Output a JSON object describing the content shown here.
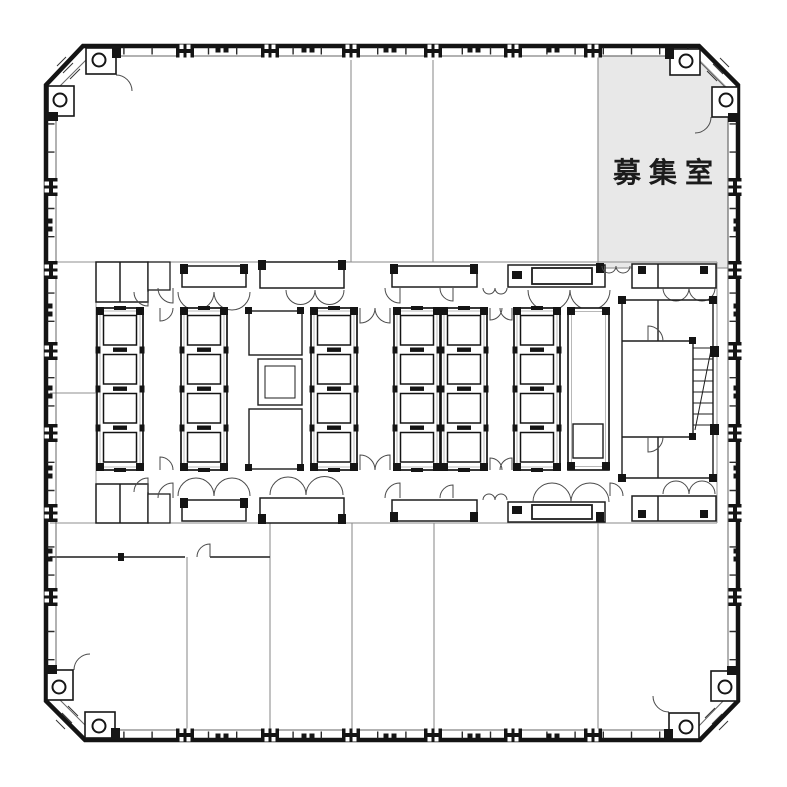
{
  "available_room": {
    "label": "募集室",
    "fill": "#e8e8e8",
    "outline": "#9b9b9b",
    "text_color": "#1b1b1b"
  },
  "colors": {
    "background": "#ffffff",
    "wall": "#141414",
    "wall_inner_line": "#666666",
    "core_line": "#1d1d1d",
    "light_line": "#9a9a9a",
    "partition": "#8f8f8f",
    "door_arc": "#4a4a4a"
  }
}
